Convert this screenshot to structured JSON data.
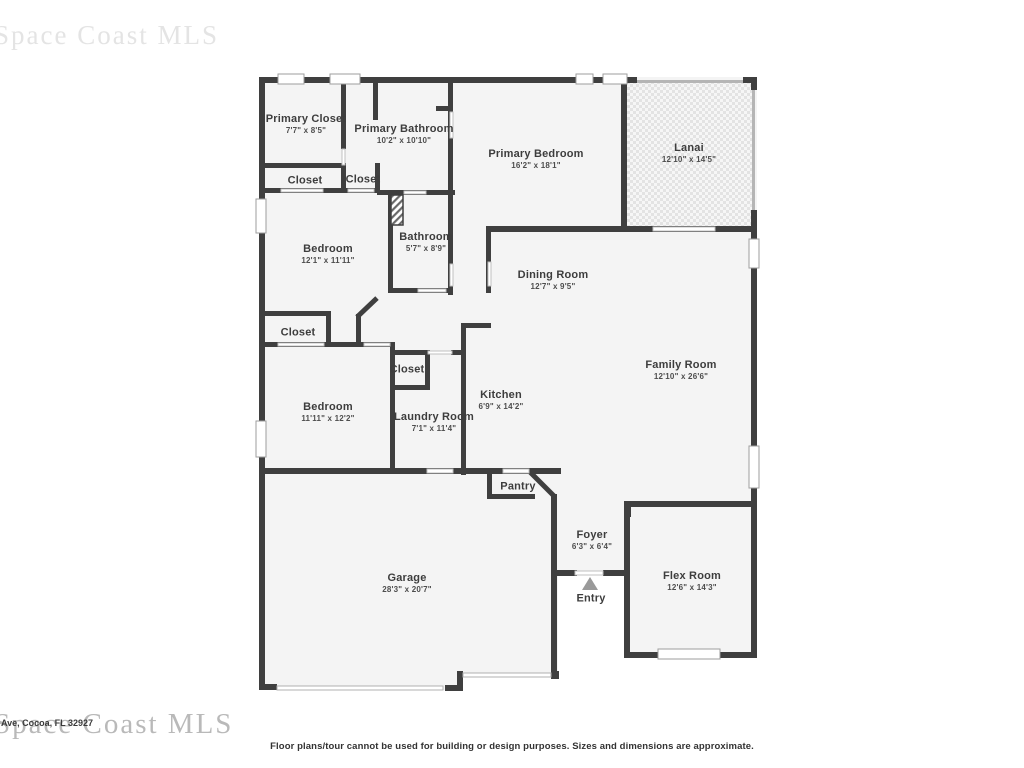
{
  "watermarks": {
    "top_left": "Space Coast MLS",
    "bottom_left": "Space Coast MLS"
  },
  "address_fragment": "Ave, Cocoa, FL 32927",
  "footer": {
    "disclaimer": "Floor plans/tour cannot be used for building or design purposes. Sizes and dimensions are approximate."
  },
  "colors": {
    "wall": "#3f3f3f",
    "room_fill": "#f4f4f4",
    "lanai_dot": "#e3e3e3",
    "light_wall": "#b5b5b5",
    "entry_arrow": "#9a9a9a",
    "label_text": "#3d3d3d"
  },
  "rooms": [
    {
      "id": "primary-closet",
      "name": "Primary Closet",
      "dims": "7'7\" x 8'5\"",
      "x": 306,
      "y": 124
    },
    {
      "id": "primary-bathroom",
      "name": "Primary Bathroom",
      "dims": "10'2\" x 10'10\"",
      "x": 404,
      "y": 134
    },
    {
      "id": "primary-bedroom",
      "name": "Primary Bedroom",
      "dims": "16'2\" x 18'1\"",
      "x": 536,
      "y": 159
    },
    {
      "id": "lanai",
      "name": "Lanai",
      "dims": "12'10\" x 14'5\"",
      "x": 689,
      "y": 153
    },
    {
      "id": "closet-hall-left",
      "name": "Closet",
      "dims": "",
      "x": 305,
      "y": 181
    },
    {
      "id": "closet-hall-right",
      "name": "Closet",
      "dims": "",
      "x": 363,
      "y": 180
    },
    {
      "id": "bedroom-upper",
      "name": "Bedroom",
      "dims": "12'1\" x 11'11\"",
      "x": 328,
      "y": 254
    },
    {
      "id": "bathroom",
      "name": "Bathroom",
      "dims": "5'7\" x 8'9\"",
      "x": 426,
      "y": 242
    },
    {
      "id": "dining-room",
      "name": "Dining Room",
      "dims": "12'7\" x 9'5\"",
      "x": 553,
      "y": 280
    },
    {
      "id": "family-room",
      "name": "Family Room",
      "dims": "12'10\" x 26'6\"",
      "x": 681,
      "y": 370
    },
    {
      "id": "closet-bedroom",
      "name": "Closet",
      "dims": "",
      "x": 298,
      "y": 333
    },
    {
      "id": "closet-laundry",
      "name": "Closet",
      "dims": "",
      "x": 407,
      "y": 370
    },
    {
      "id": "bedroom-lower",
      "name": "Bedroom",
      "dims": "11'11\" x 12'2\"",
      "x": 328,
      "y": 412
    },
    {
      "id": "laundry-room",
      "name": "Laundry Room",
      "dims": "7'1\" x 11'4\"",
      "x": 434,
      "y": 422
    },
    {
      "id": "kitchen",
      "name": "Kitchen",
      "dims": "6'9\" x 14'2\"",
      "x": 501,
      "y": 400
    },
    {
      "id": "pantry",
      "name": "Pantry",
      "dims": "",
      "x": 518,
      "y": 487
    },
    {
      "id": "garage",
      "name": "Garage",
      "dims": "28'3\" x 20'7\"",
      "x": 407,
      "y": 583
    },
    {
      "id": "foyer",
      "name": "Foyer",
      "dims": "6'3\" x 6'4\"",
      "x": 592,
      "y": 540
    },
    {
      "id": "entry",
      "name": "Entry",
      "dims": "",
      "x": 591,
      "y": 599
    },
    {
      "id": "flex-room",
      "name": "Flex Room",
      "dims": "12'6\" x 14'3\"",
      "x": 692,
      "y": 581
    }
  ]
}
